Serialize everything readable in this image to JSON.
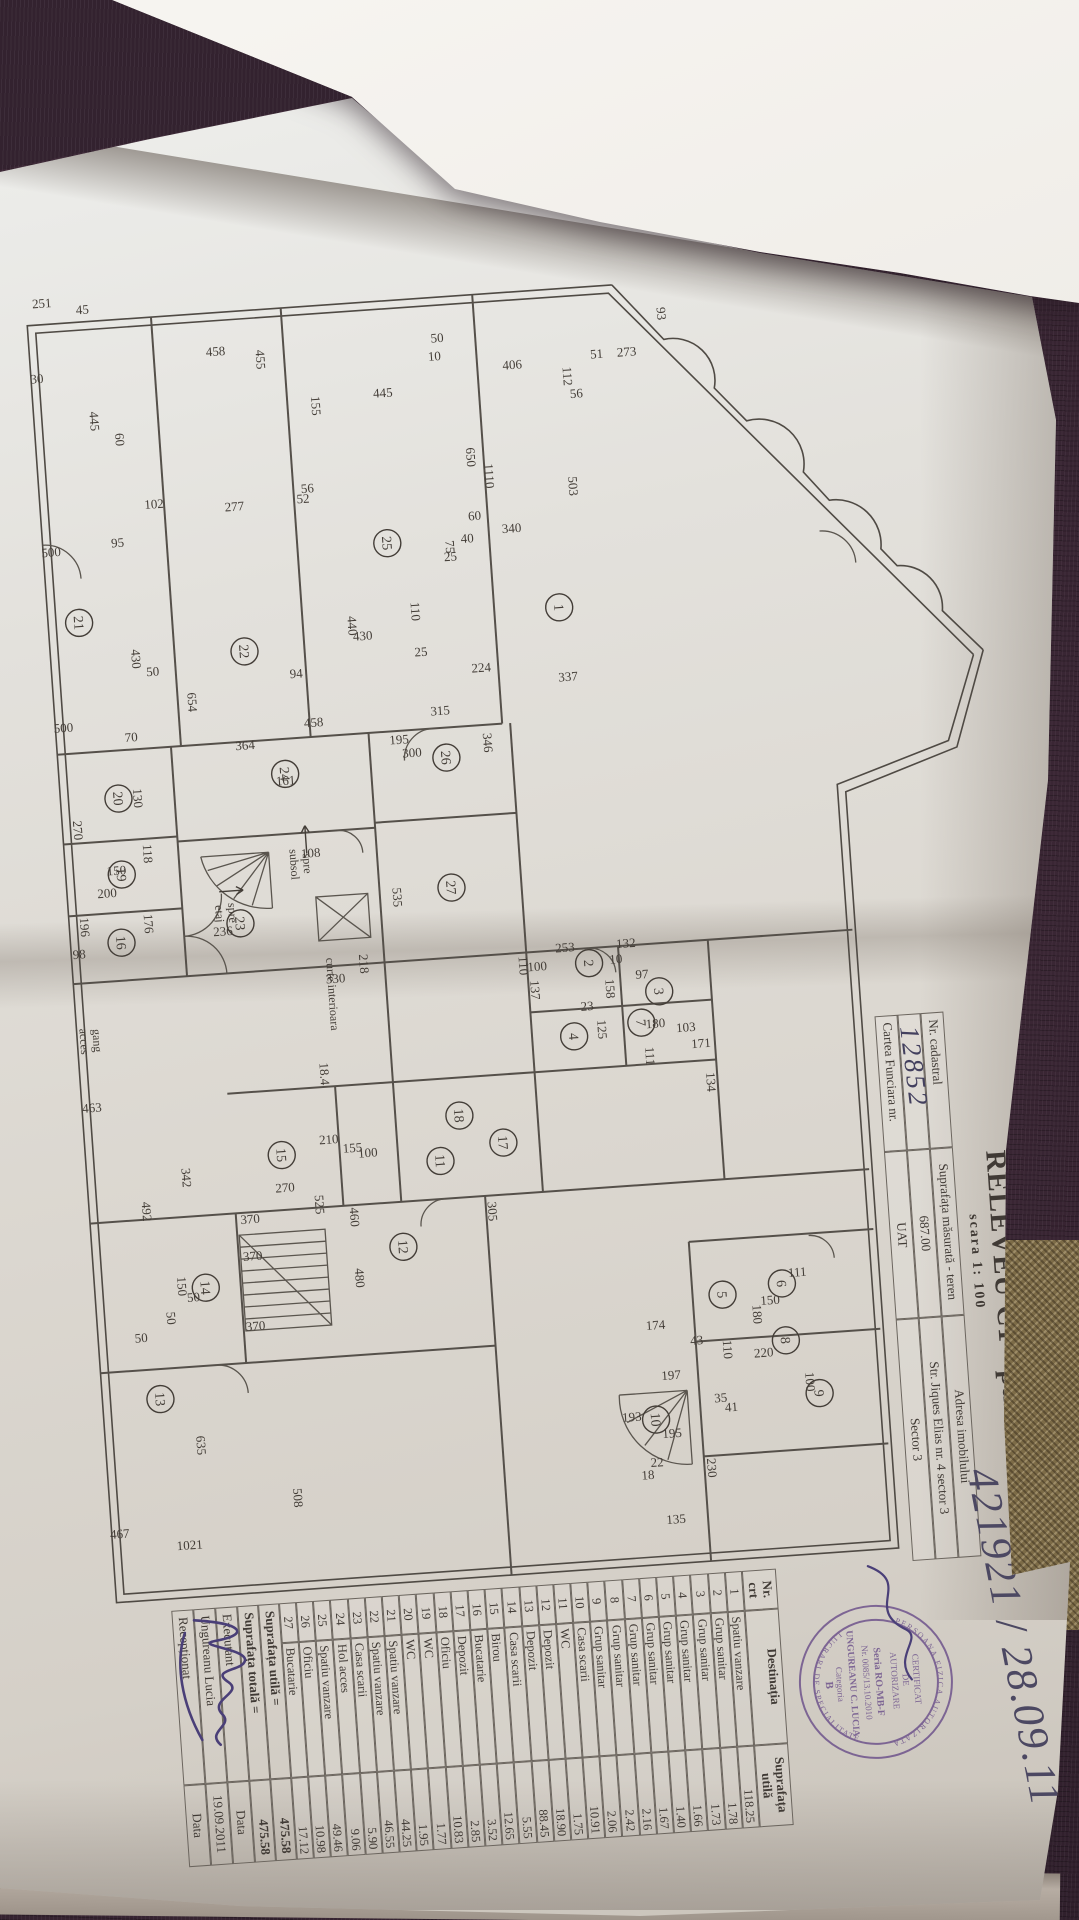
{
  "photo": {
    "registration_handwritten": "421921 / 28.09.11"
  },
  "header": {
    "title": "RELEVEU C1 - parter",
    "scale": "scara 1: 100"
  },
  "cadastral": {
    "nr_cadastral_label": "Nr. cadastral",
    "nr_cadastral_value": "12852",
    "suprafata_label": "Suprafața măsurată - teren",
    "suprafata_value": "687.00",
    "adresa_label": "Adresa imobilului",
    "adresa_value": "Str. Jiques Elias nr. 4  sector 3",
    "carte_funciara_label": "Cartea Funciara nr.",
    "uat_label": "UAT",
    "uat_value": "Sector 3"
  },
  "stamp": {
    "rim_top": "PERSOANA FIZICA AUTORIZATA",
    "rim_bottom": "LUCRARI DE SPECIALITATE",
    "cert1": "CERTIFICAT",
    "cert2": "DE",
    "cert3": "AUTORIZARE",
    "seria": "Seria RO-MB-F",
    "nr": "Nr. 0085/13.10.2010",
    "name": "UNGUREANU C. LUCIA",
    "categoria": "Categoria",
    "categoria_value": "B"
  },
  "rooms_table": {
    "headers": [
      "Nr.\ncrt",
      "Destinația",
      "Suprafața\nutilă"
    ],
    "rows": [
      [
        "1",
        "Spatiu vanzare",
        "118.25"
      ],
      [
        "2",
        "Grup sanitar",
        "1.78"
      ],
      [
        "3",
        "Grup sanitar",
        "1.73"
      ],
      [
        "4",
        "Grup sanitar",
        "1.66"
      ],
      [
        "5",
        "Grup sanitar",
        "1.40"
      ],
      [
        "6",
        "Grup sanitar",
        "1.67"
      ],
      [
        "7",
        "Grup sanitar",
        "2.16"
      ],
      [
        "8",
        "Grup sanitar",
        "2.42"
      ],
      [
        "9",
        "Grup sanitar",
        "2.06"
      ],
      [
        "10",
        "Casa scarii",
        "10.91"
      ],
      [
        "11",
        "WC",
        "1.75"
      ],
      [
        "12",
        "Depozit",
        "18.90"
      ],
      [
        "13",
        "Depozit",
        "88.45"
      ],
      [
        "14",
        "Casa scarii",
        "5.55"
      ],
      [
        "15",
        "Birou",
        "12.65"
      ],
      [
        "16",
        "Bucatarie",
        "3.52"
      ],
      [
        "17",
        "Depozit",
        "2.85"
      ],
      [
        "18",
        "Oficiu",
        "10.83"
      ],
      [
        "19",
        "WC",
        "1.77"
      ],
      [
        "20",
        "WC",
        "1.95"
      ],
      [
        "21",
        "Spatiu vanzare",
        "44.25"
      ],
      [
        "22",
        "Spatiu vanzare",
        "46.55"
      ],
      [
        "23",
        "Casa scarii",
        "5.90"
      ],
      [
        "24",
        "Hol acces",
        "9.06"
      ],
      [
        "25",
        "Spatiu vanzare",
        "49.46"
      ],
      [
        "26",
        "Oficiu",
        "10.98"
      ],
      [
        "27",
        "Bucatarie",
        "17.12"
      ]
    ],
    "totals": [
      [
        "Suprafața utilă   =",
        "475.58"
      ],
      [
        "Suprafața totală  =",
        "475.58"
      ]
    ],
    "footer": [
      [
        "Executant",
        "Data"
      ],
      [
        "Ungureanu Lucia",
        "19.09.2011"
      ],
      [
        "Recepționat",
        "Data"
      ]
    ]
  },
  "plan": {
    "rooms": [
      {
        "n": "1",
        "x": 358,
        "y": 505
      },
      {
        "n": "2",
        "x": 715,
        "y": 500
      },
      {
        "n": "3",
        "x": 748,
        "y": 432
      },
      {
        "n": "4",
        "x": 787,
        "y": 520
      },
      {
        "n": "5",
        "x": 1055,
        "y": 390
      },
      {
        "n": "6",
        "x": 1048,
        "y": 330
      },
      {
        "n": "7",
        "x": 778,
        "y": 452
      },
      {
        "n": "8",
        "x": 1105,
        "y": 330
      },
      {
        "n": "9",
        "x": 1160,
        "y": 300
      },
      {
        "n": "10",
        "x": 1175,
        "y": 465
      },
      {
        "n": "11",
        "x": 902,
        "y": 662
      },
      {
        "n": "12",
        "x": 985,
        "y": 705
      },
      {
        "n": "13",
        "x": 1120,
        "y": 958
      },
      {
        "n": "14",
        "x": 1012,
        "y": 905
      },
      {
        "n": "15",
        "x": 885,
        "y": 820
      },
      {
        "n": "16",
        "x": 662,
        "y": 965
      },
      {
        "n": "17",
        "x": 888,
        "y": 598
      },
      {
        "n": "18",
        "x": 858,
        "y": 640
      },
      {
        "n": "19",
        "x": 594,
        "y": 960
      },
      {
        "n": "20",
        "x": 518,
        "y": 958
      },
      {
        "n": "21",
        "x": 340,
        "y": 985
      },
      {
        "n": "22",
        "x": 380,
        "y": 822
      },
      {
        "n": "23",
        "x": 651,
        "y": 845
      },
      {
        "n": "24",
        "x": 505,
        "y": 790
      },
      {
        "n": "25",
        "x": 282,
        "y": 672
      },
      {
        "n": "26",
        "x": 500,
        "y": 628
      },
      {
        "n": "27",
        "x": 630,
        "y": 632
      }
    ],
    "dims": [
      {
        "t": "251",
        "x": 23,
        "y": 1000,
        "v": 1
      },
      {
        "t": "45",
        "x": 32,
        "y": 960,
        "v": 1
      },
      {
        "t": "458",
        "x": 83,
        "y": 830,
        "v": 1
      },
      {
        "t": "30",
        "x": 98,
        "y": 1010,
        "v": 1
      },
      {
        "t": "445",
        "x": 140,
        "y": 960,
        "v": 0
      },
      {
        "t": "60",
        "x": 160,
        "y": 936,
        "v": 0
      },
      {
        "t": "455",
        "x": 90,
        "y": 790,
        "v": 0
      },
      {
        "t": "155",
        "x": 140,
        "y": 738,
        "v": 0
      },
      {
        "t": "445",
        "x": 136,
        "y": 666,
        "v": 1
      },
      {
        "t": "406",
        "x": 117,
        "y": 535,
        "v": 1
      },
      {
        "t": "112",
        "x": 128,
        "y": 485,
        "v": 0
      },
      {
        "t": "51",
        "x": 112,
        "y": 450,
        "v": 1
      },
      {
        "t": "273",
        "x": 112,
        "y": 420,
        "v": 1
      },
      {
        "t": "56",
        "x": 150,
        "y": 473,
        "v": 1
      },
      {
        "t": "50",
        "x": 85,
        "y": 608,
        "v": 1
      },
      {
        "t": "10",
        "x": 103,
        "y": 612,
        "v": 1
      },
      {
        "t": "93",
        "x": 72,
        "y": 387,
        "v": 0
      },
      {
        "t": "650",
        "x": 202,
        "y": 587,
        "v": 0
      },
      {
        "t": "1110",
        "x": 222,
        "y": 570,
        "v": 0
      },
      {
        "t": "503",
        "x": 238,
        "y": 487,
        "v": 0
      },
      {
        "t": "340",
        "x": 280,
        "y": 547,
        "v": 1
      },
      {
        "t": "60",
        "x": 265,
        "y": 583,
        "v": 1
      },
      {
        "t": "40",
        "x": 287,
        "y": 592,
        "v": 1
      },
      {
        "t": "75",
        "x": 290,
        "y": 614,
        "v": 0
      },
      {
        "t": "25",
        "x": 304,
        "y": 610,
        "v": 1
      },
      {
        "t": "337",
        "x": 432,
        "y": 501,
        "v": 1
      },
      {
        "t": "102",
        "x": 231,
        "y": 902,
        "v": 1
      },
      {
        "t": "95",
        "x": 267,
        "y": 941,
        "v": 1
      },
      {
        "t": "500",
        "x": 272,
        "y": 1008,
        "v": 1
      },
      {
        "t": "500",
        "x": 448,
        "y": 1008,
        "v": 1
      },
      {
        "t": "277",
        "x": 239,
        "y": 822,
        "v": 1
      },
      {
        "t": "52",
        "x": 236,
        "y": 753,
        "v": 1
      },
      {
        "t": "56",
        "x": 226,
        "y": 748,
        "v": 1
      },
      {
        "t": "430",
        "x": 380,
        "y": 935,
        "v": 0
      },
      {
        "t": "50",
        "x": 398,
        "y": 915,
        "v": 1
      },
      {
        "t": "654",
        "x": 427,
        "y": 882,
        "v": 0
      },
      {
        "t": "70",
        "x": 462,
        "y": 941,
        "v": 1
      },
      {
        "t": "364",
        "x": 478,
        "y": 828,
        "v": 1
      },
      {
        "t": "161",
        "x": 516,
        "y": 790,
        "v": 1
      },
      {
        "t": "130",
        "x": 519,
        "y": 943,
        "v": 0
      },
      {
        "t": "270",
        "x": 547,
        "y": 1005,
        "v": 0
      },
      {
        "t": "118",
        "x": 575,
        "y": 937,
        "v": 0
      },
      {
        "t": "150",
        "x": 594,
        "y": 965,
        "v": 1
      },
      {
        "t": "200",
        "x": 616,
        "y": 976,
        "v": 1
      },
      {
        "t": "196",
        "x": 644,
        "y": 1005,
        "v": 0
      },
      {
        "t": "176",
        "x": 645,
        "y": 941,
        "v": 0
      },
      {
        "t": "98",
        "x": 675,
        "y": 1008,
        "v": 1
      },
      {
        "t": "236",
        "x": 662,
        "y": 863,
        "v": 1
      },
      {
        "t": "108",
        "x": 590,
        "y": 770,
        "v": 1
      },
      {
        "t": "218",
        "x": 700,
        "y": 729,
        "v": 0
      },
      {
        "t": "463",
        "x": 829,
        "y": 1006,
        "v": 1
      },
      {
        "t": "342",
        "x": 901,
        "y": 921,
        "v": 0
      },
      {
        "t": "492",
        "x": 932,
        "y": 963,
        "v": 0
      },
      {
        "t": "370",
        "x": 951,
        "y": 856,
        "v": 1
      },
      {
        "t": "370",
        "x": 988,
        "y": 856,
        "v": 1
      },
      {
        "t": "370",
        "x": 1058,
        "y": 858,
        "v": 1
      },
      {
        "t": "150",
        "x": 1009,
        "y": 933,
        "v": 0
      },
      {
        "t": "635",
        "x": 1169,
        "y": 925,
        "v": 0
      },
      {
        "t": "508",
        "x": 1228,
        "y": 832,
        "v": 0
      },
      {
        "t": "467",
        "x": 1256,
        "y": 1008,
        "v": 1
      },
      {
        "t": "1021",
        "x": 1272,
        "y": 939,
        "v": 1
      },
      {
        "t": "50",
        "x": 1025,
        "y": 918,
        "v": 1
      },
      {
        "t": "50",
        "x": 1040,
        "y": 946,
        "v": 0
      },
      {
        "t": "50",
        "x": 1062,
        "y": 973,
        "v": 1
      },
      {
        "t": "535",
        "x": 636,
        "y": 691,
        "v": 0
      },
      {
        "t": "330",
        "x": 717,
        "y": 754,
        "v": 1
      },
      {
        "t": "18.4",
        "x": 807,
        "y": 776,
        "v": 0
      },
      {
        "t": "210",
        "x": 877,
        "y": 772,
        "v": 1
      },
      {
        "t": "155",
        "x": 887,
        "y": 749,
        "v": 1
      },
      {
        "t": "100",
        "x": 893,
        "y": 734,
        "v": 1
      },
      {
        "t": "270",
        "x": 922,
        "y": 819,
        "v": 1
      },
      {
        "t": "525",
        "x": 937,
        "y": 790,
        "v": 0
      },
      {
        "t": "460",
        "x": 952,
        "y": 756,
        "v": 0
      },
      {
        "t": "480",
        "x": 1013,
        "y": 755,
        "v": 0
      },
      {
        "t": "305",
        "x": 956,
        "y": 618,
        "v": 0
      },
      {
        "t": "110",
        "x": 713,
        "y": 570,
        "v": 0
      },
      {
        "t": "100",
        "x": 719,
        "y": 552,
        "v": 1
      },
      {
        "t": "253",
        "x": 702,
        "y": 523,
        "v": 1
      },
      {
        "t": "132",
        "x": 702,
        "y": 462,
        "v": 1
      },
      {
        "t": "10",
        "x": 717,
        "y": 473,
        "v": 1
      },
      {
        "t": "97",
        "x": 734,
        "y": 448,
        "v": 1
      },
      {
        "t": "23",
        "x": 762,
        "y": 505,
        "v": 1
      },
      {
        "t": "125",
        "x": 782,
        "y": 496,
        "v": 0
      },
      {
        "t": "111",
        "x": 812,
        "y": 450,
        "v": 0
      },
      {
        "t": "180",
        "x": 784,
        "y": 438,
        "v": 1
      },
      {
        "t": "158",
        "x": 742,
        "y": 485,
        "v": 0
      },
      {
        "t": "137",
        "x": 738,
        "y": 560,
        "v": 0
      },
      {
        "t": "103",
        "x": 790,
        "y": 408,
        "v": 1
      },
      {
        "t": "134",
        "x": 842,
        "y": 391,
        "v": 0
      },
      {
        "t": "171",
        "x": 807,
        "y": 394,
        "v": 1
      },
      {
        "t": "150",
        "x": 1068,
        "y": 343,
        "v": 1
      },
      {
        "t": "111",
        "x": 1042,
        "y": 314,
        "v": 1
      },
      {
        "t": "220",
        "x": 1120,
        "y": 353,
        "v": 1
      },
      {
        "t": "100",
        "x": 1148,
        "y": 313,
        "v": 0
      },
      {
        "t": "180",
        "x": 1077,
        "y": 361,
        "v": 0
      },
      {
        "t": "35",
        "x": 1162,
        "y": 399,
        "v": 1
      },
      {
        "t": "41",
        "x": 1172,
        "y": 389,
        "v": 1
      },
      {
        "t": "174",
        "x": 1085,
        "y": 459,
        "v": 1
      },
      {
        "t": "43",
        "x": 1103,
        "y": 419,
        "v": 1
      },
      {
        "t": "197",
        "x": 1136,
        "y": 447,
        "v": 1
      },
      {
        "t": "110",
        "x": 1110,
        "y": 393,
        "v": 0
      },
      {
        "t": "193",
        "x": 1175,
        "y": 489,
        "v": 1
      },
      {
        "t": "195",
        "x": 1194,
        "y": 450,
        "v": 1
      },
      {
        "t": "230",
        "x": 1227,
        "y": 417,
        "v": 0
      },
      {
        "t": "135",
        "x": 1280,
        "y": 452,
        "v": 1
      },
      {
        "t": "22",
        "x": 1222,
        "y": 467,
        "v": 1
      },
      {
        "t": "18",
        "x": 1234,
        "y": 477,
        "v": 1
      },
      {
        "t": "458",
        "x": 460,
        "y": 758,
        "v": 1
      },
      {
        "t": "195",
        "x": 483,
        "y": 674,
        "v": 1
      },
      {
        "t": "300",
        "x": 497,
        "y": 662,
        "v": 1
      },
      {
        "t": "224",
        "x": 417,
        "y": 587,
        "v": 1
      },
      {
        "t": "315",
        "x": 457,
        "y": 631,
        "v": 1
      },
      {
        "t": "346",
        "x": 488,
        "y": 590,
        "v": 0
      },
      {
        "t": "94",
        "x": 410,
        "y": 772,
        "v": 1
      },
      {
        "t": "440",
        "x": 362,
        "y": 717,
        "v": 0
      },
      {
        "t": "430",
        "x": 377,
        "y": 703,
        "v": 1
      },
      {
        "t": "110",
        "x": 352,
        "y": 653,
        "v": 0
      },
      {
        "t": "25",
        "x": 397,
        "y": 646,
        "v": 1
      }
    ],
    "notes": [
      {
        "t": "spre\nsubsol",
        "x": 596,
        "y": 778,
        "arrow": "left"
      },
      {
        "t": "spre\netaj",
        "x": 640,
        "y": 856,
        "arrow": "up"
      },
      {
        "t": "gang\nacces",
        "x": 758,
        "y": 1000,
        "arrow": ""
      },
      {
        "t": "curte interioara",
        "x": 728,
        "y": 762,
        "arrow": ""
      }
    ]
  }
}
